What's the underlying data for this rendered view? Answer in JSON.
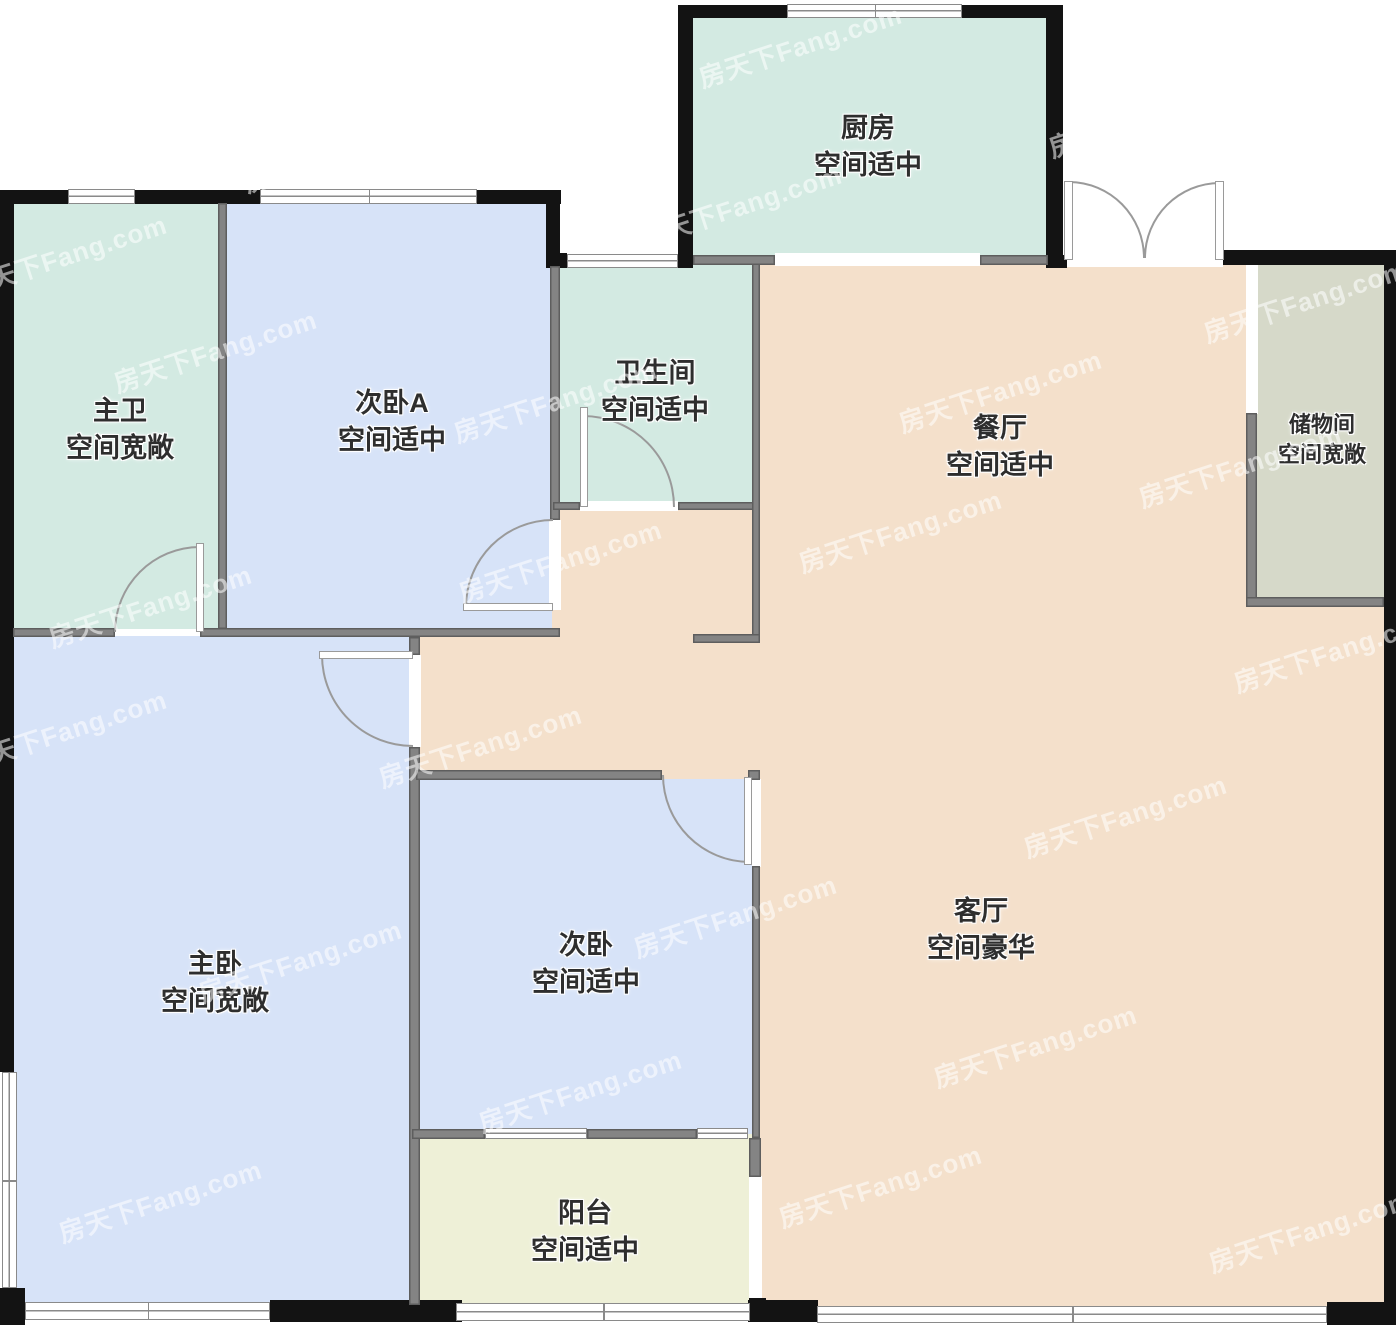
{
  "watermark": {
    "text": "房天下Fang.com"
  },
  "rooms": [
    {
      "id": "kitchen",
      "name": "厨房",
      "size_label": "空间适中"
    },
    {
      "id": "master-bath",
      "name": "主卫",
      "size_label": "空间宽敞"
    },
    {
      "id": "bedroom-a",
      "name": "次卧A",
      "size_label": "空间适中"
    },
    {
      "id": "bathroom",
      "name": "卫生间",
      "size_label": "空间适中"
    },
    {
      "id": "dining",
      "name": "餐厅",
      "size_label": "空间适中"
    },
    {
      "id": "storage",
      "name": "储物间",
      "size_label": "空间宽敞"
    },
    {
      "id": "master-bedroom",
      "name": "主卧",
      "size_label": "空间宽敞"
    },
    {
      "id": "bedroom",
      "name": "次卧",
      "size_label": "空间适中"
    },
    {
      "id": "living",
      "name": "客厅",
      "size_label": "空间豪华"
    },
    {
      "id": "balcony",
      "name": "阳台",
      "size_label": "空间适中"
    }
  ],
  "colors": {
    "room_mint": "#d3eae2",
    "room_blue": "#d7e3f8",
    "room_peach": "#f4e0cb",
    "room_balcony": "#eef0d7",
    "room_storage": "#d6d9c9",
    "wall_interior": "#848484",
    "wall_interior_edge": "#5e5e5e",
    "wall_exterior": "#131313",
    "door_arc": "#9a9a9a",
    "window_frame": "#8a8a8a",
    "label_text": "#2e2e2e",
    "watermark_white": "#ffffff"
  }
}
